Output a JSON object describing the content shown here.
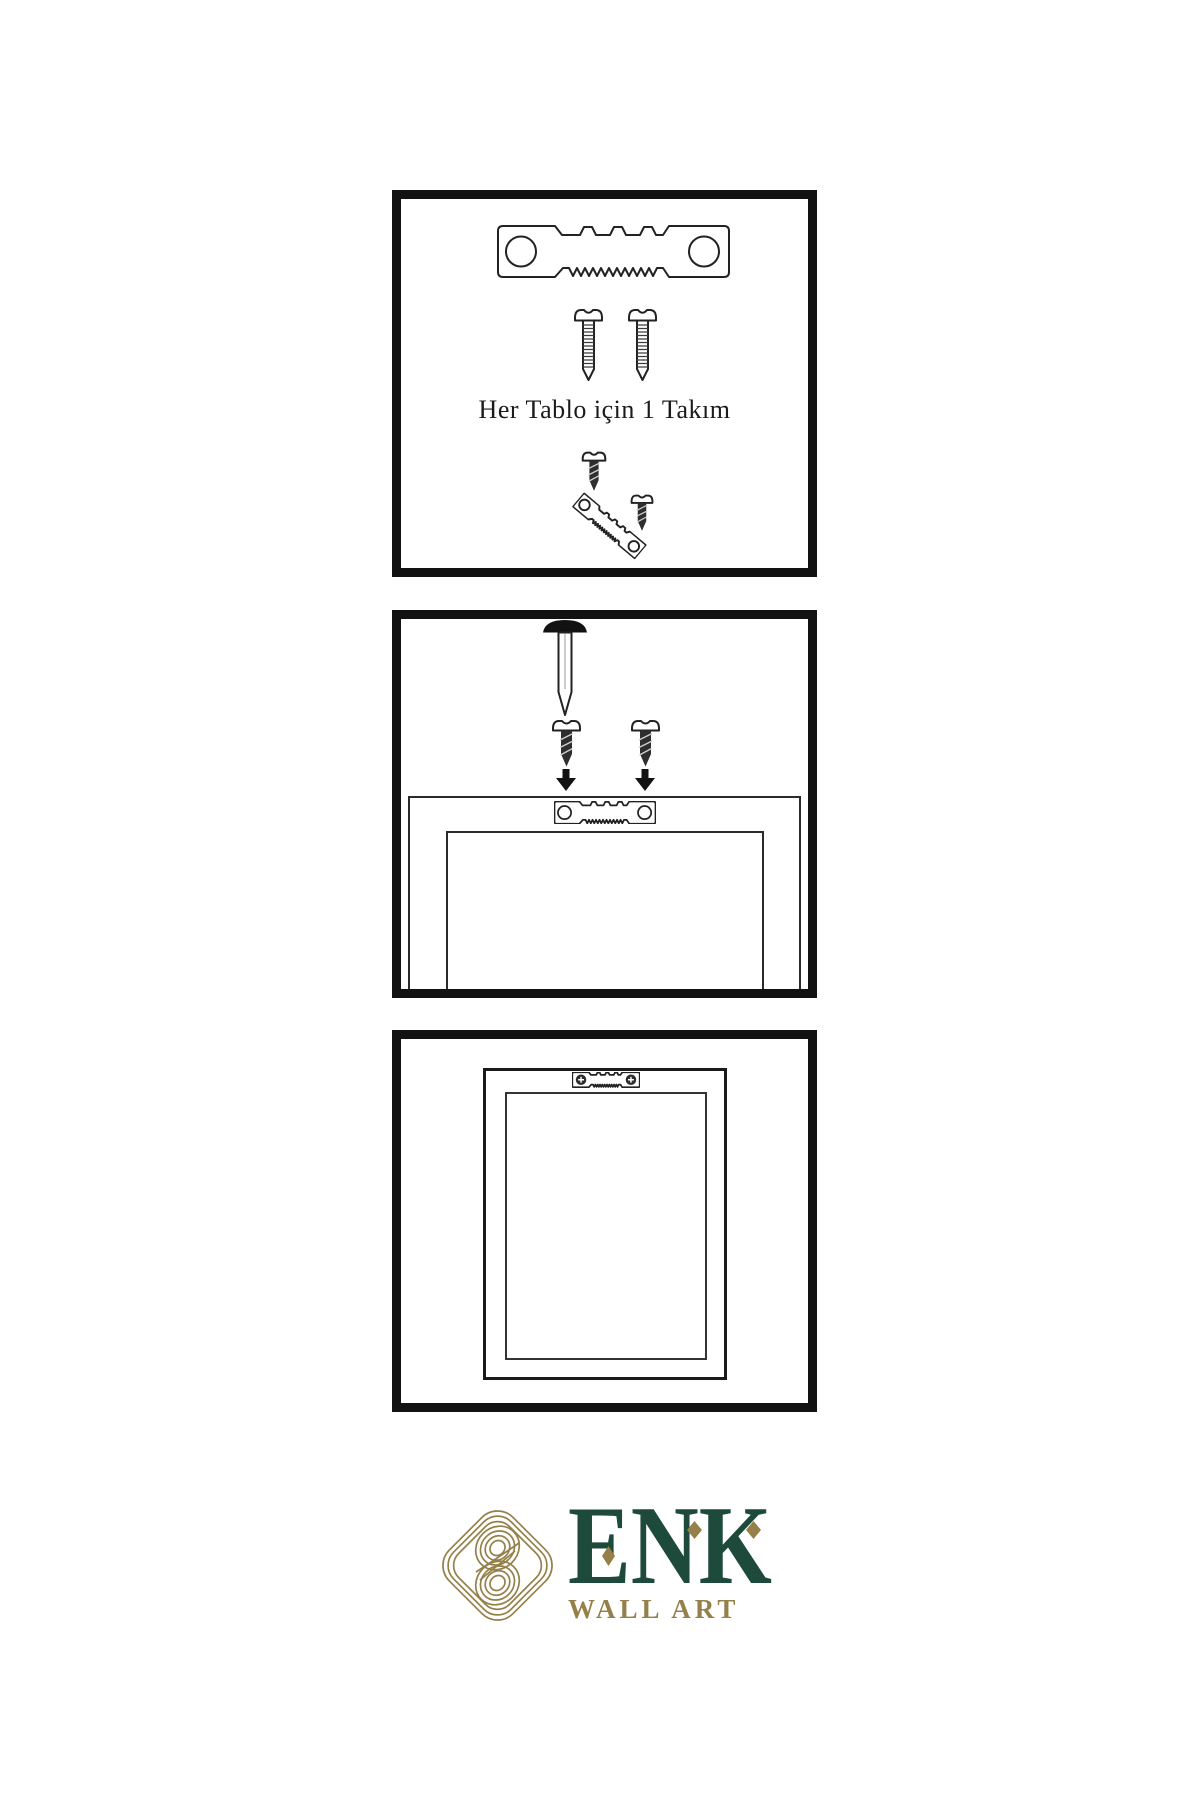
{
  "colors": {
    "background": "#ffffff",
    "ink": "#222222",
    "panel_border": "#121212",
    "screw_dark": "#2e2e2e",
    "brand_green": "#1d4a3b",
    "brand_gold": "#95804a"
  },
  "panels": {
    "kit": {
      "caption": "Her Tablo için 1 Takım",
      "icons": [
        "sawtooth-hanger-icon",
        "screw-icon",
        "screw-icon",
        "dark-screw-icon",
        "angled-sawtooth-hanger-icon",
        "dark-screw-icon"
      ]
    },
    "mounting": {
      "icons": [
        "wall-nail-icon",
        "dark-screw-icon",
        "down-arrow-icon",
        "dark-screw-icon",
        "down-arrow-icon",
        "sawtooth-hanger-icon",
        "frame-back"
      ]
    },
    "hung": {
      "icons": [
        "frame-front",
        "installed-sawtooth-hanger-icon"
      ]
    }
  },
  "logo": {
    "brand": "ENK",
    "subtitle": "WALL ART",
    "icons": [
      "knot-medallion-icon",
      "diamond-accent-icon",
      "diamond-accent-icon",
      "diamond-accent-icon"
    ]
  }
}
